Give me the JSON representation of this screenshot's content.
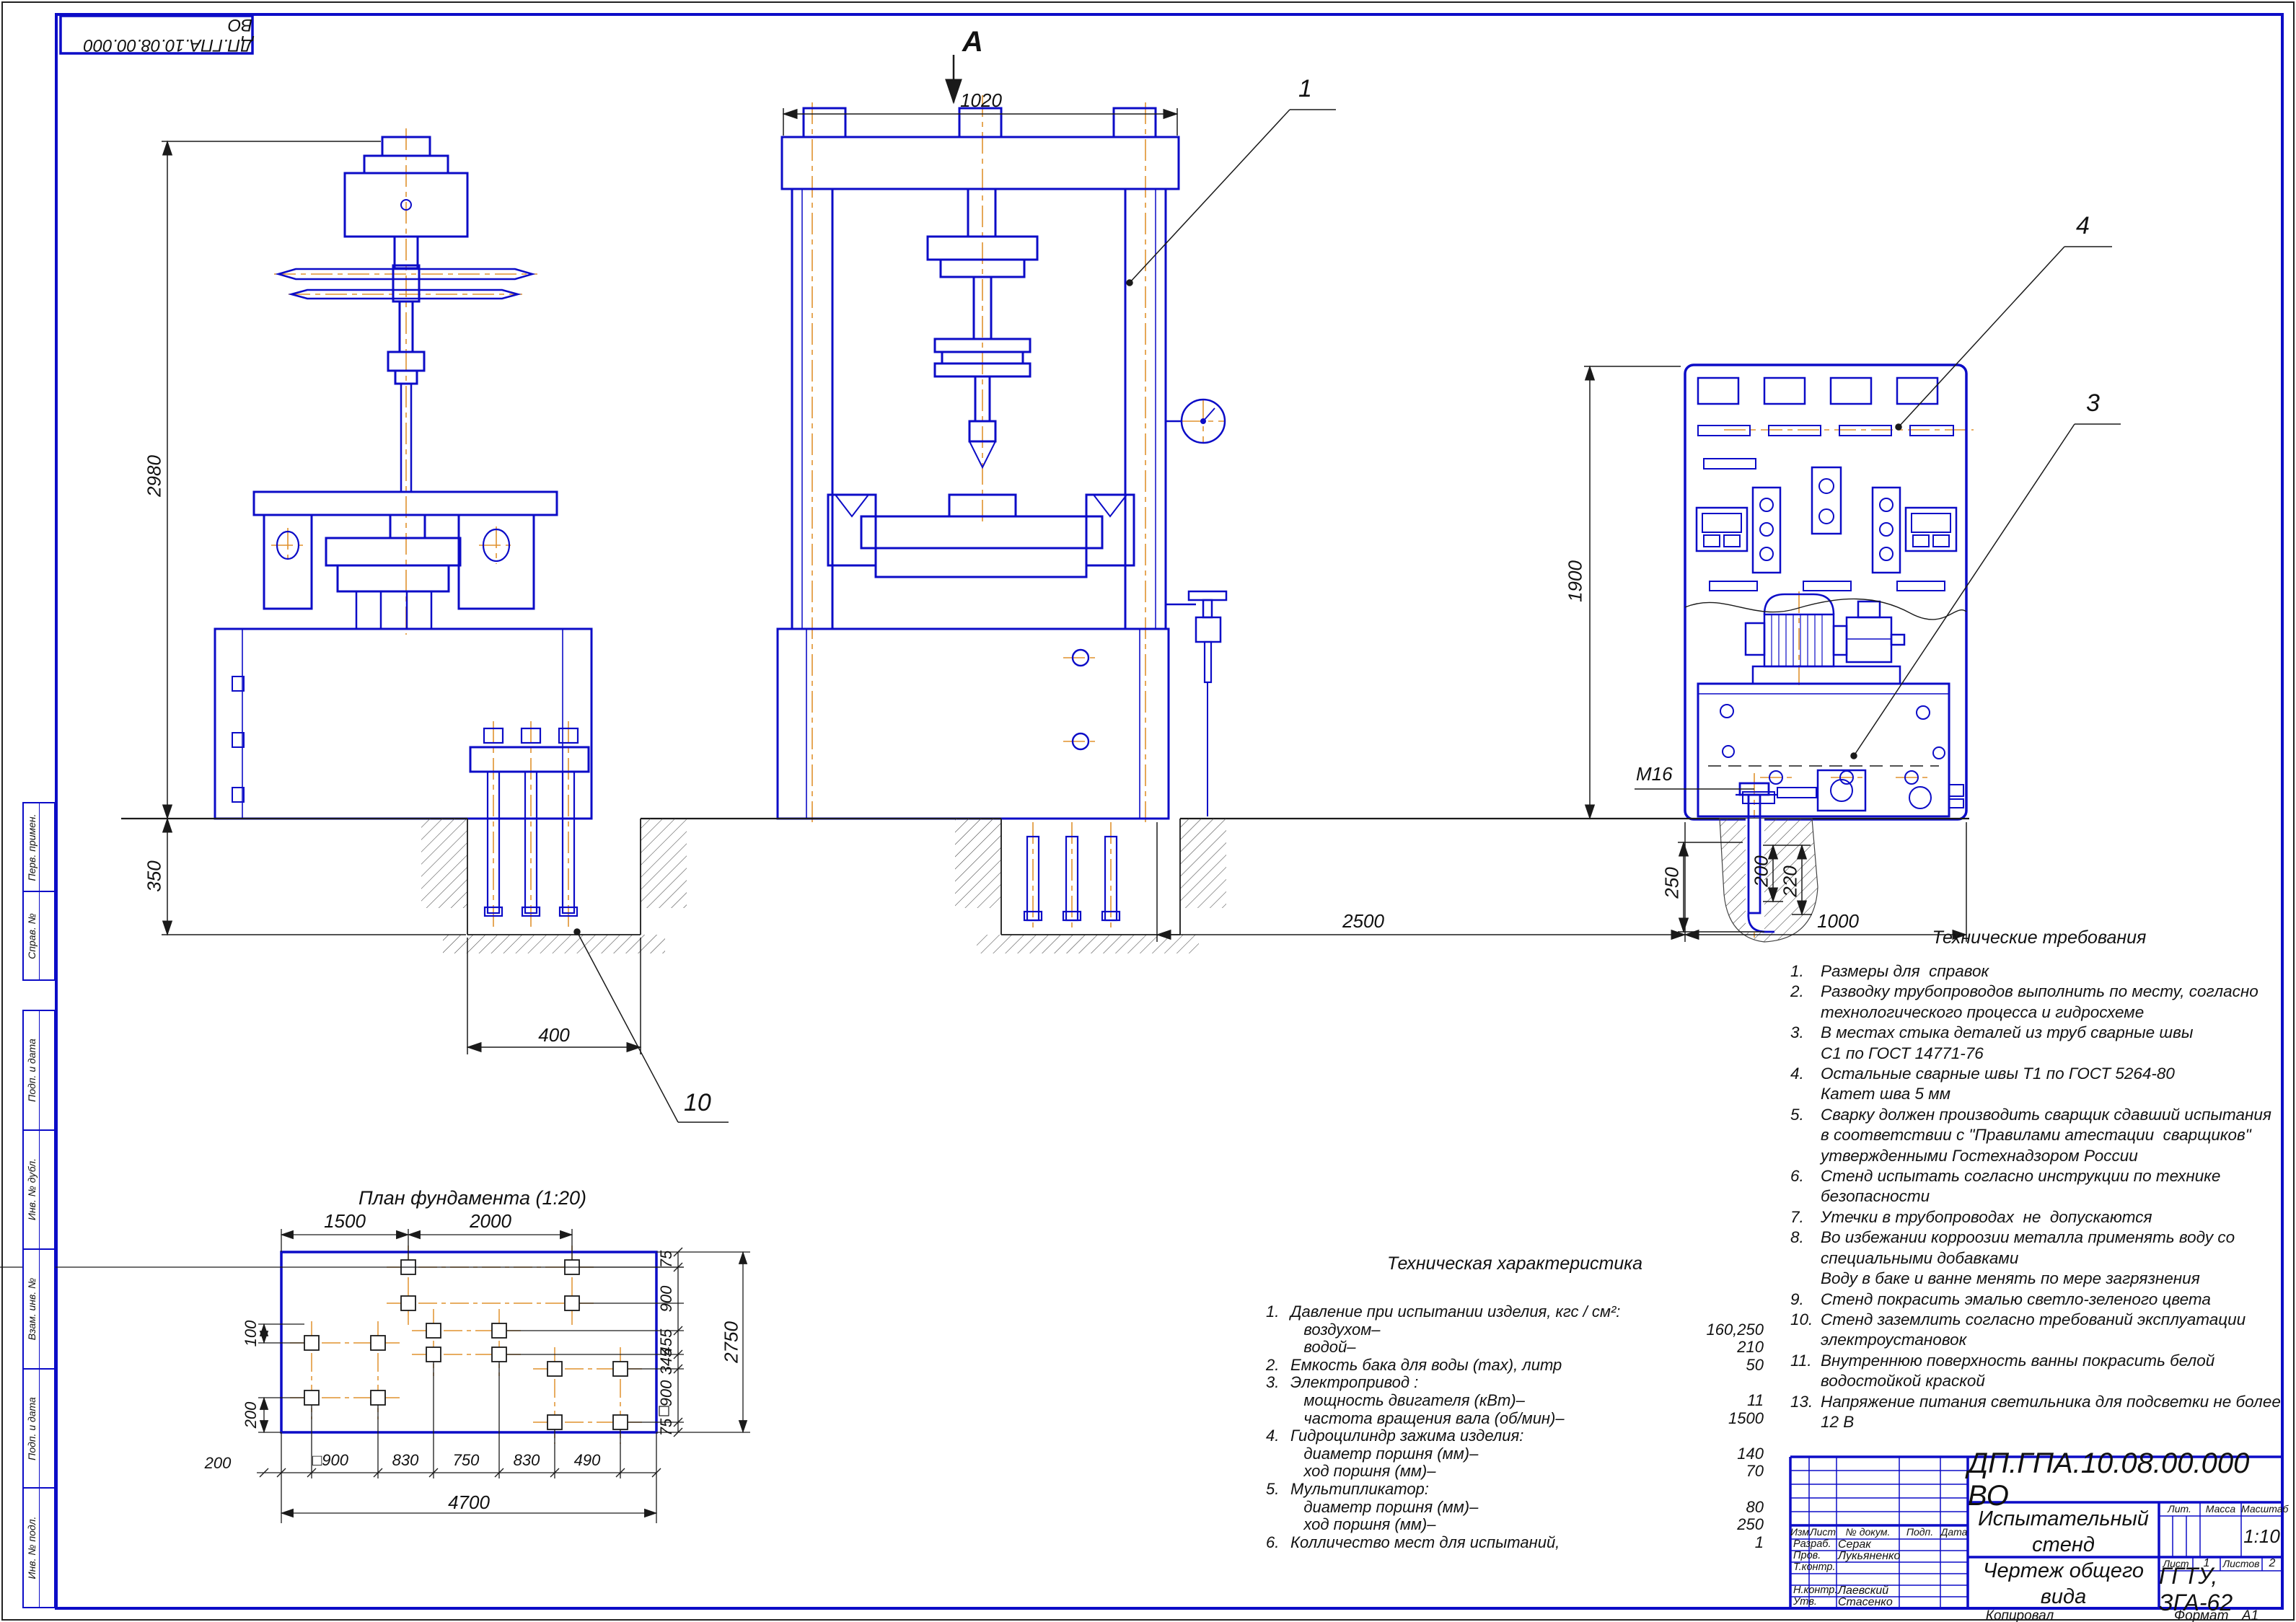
{
  "stamp": {
    "doc_number_rotated": "ДП.ГПА.10.08.00.000 ВО"
  },
  "margin_columns": {
    "group1": [
      "Перв. примен.",
      "Справ. №"
    ],
    "group2": [
      "Подп. и дата",
      "Инв. № дубл.",
      "Взам. инв. №",
      "Подп. и дата",
      "Инв. № подл."
    ]
  },
  "section_label": "А",
  "callouts": {
    "press": "1",
    "panel": "4",
    "pump_unit": "3",
    "foundation_pit": "10"
  },
  "colors": {
    "line_blue": "#0c0cc7",
    "centerline_orange": "#e0922f",
    "dim_black": "#1a1a1a"
  },
  "dimensions": {
    "front_width": "1020",
    "press_height": "2980",
    "foundation_depth": "350",
    "pit_width": "400",
    "panel_height": "1900",
    "press_to_unit": "2500",
    "unit_width": "1000",
    "anchor_depth": "250",
    "anchor_embed": "200",
    "anchor_len": "220",
    "anchor_thread": "M16"
  },
  "foundation_plan": {
    "title": "План фундамента (1:20)",
    "top_dims": [
      "1500",
      "2000"
    ],
    "right_dims": [
      "75",
      "900",
      "455",
      "345",
      "900",
      "75"
    ],
    "right_total": "2750",
    "bottom_dims": [
      "200",
      "□900",
      "830",
      "750",
      "830",
      "490"
    ],
    "bottom_total": "4700",
    "left_dims": [
      "100",
      "200"
    ]
  },
  "tech_characteristics": {
    "title": "Техническая характеристика",
    "rows": [
      {
        "num": "1.",
        "label": "Давление при испытании изделия, кгс / см²:",
        "value": ""
      },
      {
        "num": "",
        "label": "   воздухом–",
        "value": "160,250"
      },
      {
        "num": "",
        "label": "   водой–",
        "value": "210"
      },
      {
        "num": "2.",
        "label": "Емкость бака для воды (max), литр",
        "value": "50"
      },
      {
        "num": "3.",
        "label": "Электропривод :",
        "value": ""
      },
      {
        "num": "",
        "label": "   мощность двигателя (кВт)–",
        "value": "11"
      },
      {
        "num": "",
        "label": "   частота вращения вала (об/мин)–",
        "value": "1500"
      },
      {
        "num": "4.",
        "label": "Гидроцилиндр зажима изделия:",
        "value": ""
      },
      {
        "num": "",
        "label": "   диаметр поршня (мм)–",
        "value": "140"
      },
      {
        "num": "",
        "label": "   ход поршня (мм)–",
        "value": "70"
      },
      {
        "num": "5.",
        "label": "Мультипликатор:",
        "value": ""
      },
      {
        "num": "",
        "label": "   диаметр поршня (мм)–",
        "value": "80"
      },
      {
        "num": "",
        "label": "   ход поршня (мм)–",
        "value": "250"
      },
      {
        "num": "6.",
        "label": "Колличество мест для испытаний,",
        "value": "1"
      }
    ]
  },
  "tech_requirements": {
    "title": "Технические требования",
    "lines": [
      {
        "num": "1.",
        "text": "Размеры для  справок"
      },
      {
        "num": "2.",
        "text": "Разводку трубопроводов выполнить по месту, согласно"
      },
      {
        "num": "",
        "text": "технологического процесса и гидросхеме"
      },
      {
        "num": "3.",
        "text": "В местах стыка деталей из труб сварные швы"
      },
      {
        "num": "",
        "text": "С1 по ГОСТ 14771-76"
      },
      {
        "num": "4.",
        "text": "Остальные сварные швы Т1 по ГОСТ 5264-80"
      },
      {
        "num": "",
        "text": "Катет шва 5 мм"
      },
      {
        "num": "5.",
        "text": "Сварку должен производить сварщик сдавший испытания"
      },
      {
        "num": "",
        "text": "в соответствии с \"Правилами атестации  сварщиков\""
      },
      {
        "num": "",
        "text": "утвержденными Гостехнадзором России"
      },
      {
        "num": "6.",
        "text": "Стенд испытать согласно инструкции по технике"
      },
      {
        "num": "",
        "text": "безопасности"
      },
      {
        "num": "7.",
        "text": "Утечки в трубопроводах  не  допускаются"
      },
      {
        "num": "8.",
        "text": "Во избежании корроозии металла применять воду со"
      },
      {
        "num": "",
        "text": "специальными добавками"
      },
      {
        "num": "",
        "text": "Воду в баке и ванне менять по мере загрязнения"
      },
      {
        "num": "9.",
        "text": "Стенд покрасить эмалью светло-зеленого цвета"
      },
      {
        "num": "10.",
        "text": "Стенд заземлить согласно требований эксплуатации"
      },
      {
        "num": "",
        "text": "электроустановок"
      },
      {
        "num": "11.",
        "text": "Внутреннюю поверхность ванны покрасить белой"
      },
      {
        "num": "",
        "text": "водостойкой краской"
      },
      {
        "num": "13.",
        "text": "Напряжение питания светильника для подсветки не более"
      },
      {
        "num": "",
        "text": "12 В"
      }
    ]
  },
  "title_block": {
    "doc_number": "ДП.ГПА.10.08.00.000 ВО",
    "title_line1": "Испытательный стенд",
    "title_line2": "Чертеж общего вида",
    "cols": {
      "izm": "Изм.",
      "list": "Лист",
      "doc": "№ докум.",
      "sign": "Подп.",
      "date": "Дата"
    },
    "rows": [
      {
        "role": "Разраб.",
        "name": "Серак"
      },
      {
        "role": "Пров.",
        "name": "Лукьяненко"
      },
      {
        "role": "Т.контр.",
        "name": ""
      },
      {
        "role": "",
        "name": ""
      },
      {
        "role": "Н.контр.",
        "name": "Лаевский"
      },
      {
        "role": "Утв.",
        "name": "Стасенко"
      }
    ],
    "lit_label": "Лит.",
    "mass_label": "Масса",
    "scale_label": "Масштаб",
    "scale": "1:10",
    "sheet_label": "Лист",
    "sheet": "1",
    "sheets_label": "Листов",
    "sheets": "2",
    "org": "ГГТУ, ЗГА-62"
  },
  "footer": {
    "copied_label": "Копировал",
    "format_label": "Формат",
    "format_value": "А1"
  }
}
